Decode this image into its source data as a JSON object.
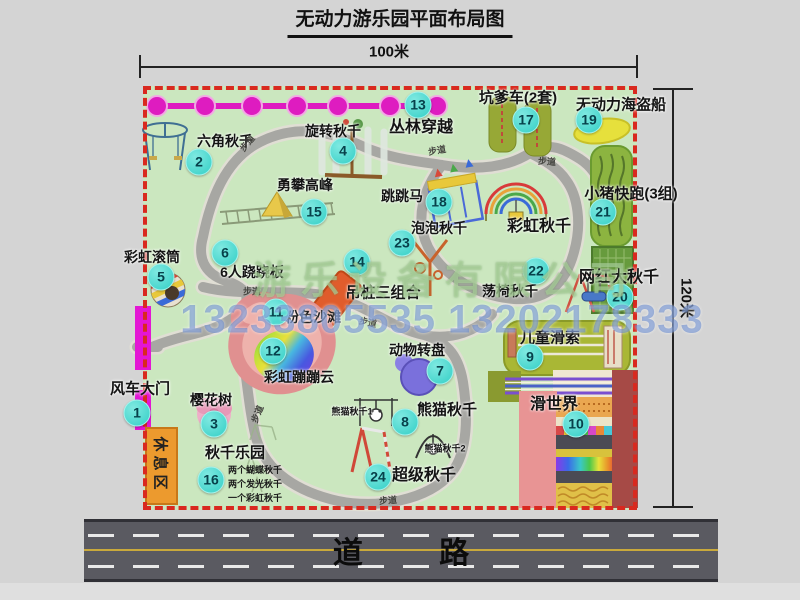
{
  "title": "无动力游乐园平面布局图",
  "dimensions": {
    "width": "100米",
    "height": "120米"
  },
  "road_label": "道 路",
  "walkway_label": "步道",
  "rest_area_label": "休息区",
  "rainbow_swing_label": "彩虹秋千",
  "watermark": {
    "company": "游乐设备有限公司",
    "phone": "13233805535 13202178333"
  },
  "colors": {
    "map_green": "#cbe7bf",
    "border_red": "#d9291f",
    "badge_teal": "#34cfc6",
    "gate_magenta": "#e316d4",
    "rest_orange": "#ec9a2e",
    "road_gray": "#5a5a61",
    "path_gray": "#a7a7a3",
    "chain_magenta": "#de1cc0"
  },
  "attractions": [
    {
      "num": "1",
      "name": "风车大门"
    },
    {
      "num": "2",
      "name": "六角秋千"
    },
    {
      "num": "3",
      "name": "樱花树"
    },
    {
      "num": "4",
      "name": "旋转秋千"
    },
    {
      "num": "5",
      "name": "彩虹滚筒"
    },
    {
      "num": "6",
      "name": "6人跷跷板"
    },
    {
      "num": "7",
      "name": "动物转盘"
    },
    {
      "num": "8",
      "name": "熊猫秋千",
      "sub_labels": [
        "熊猫秋千1",
        "熊猫秋千2"
      ]
    },
    {
      "num": "9",
      "name": "儿童滑索"
    },
    {
      "num": "10",
      "name": "滑世界"
    },
    {
      "num": "11",
      "name": "粉色沙滩"
    },
    {
      "num": "12",
      "name": "彩虹蹦蹦云"
    },
    {
      "num": "13",
      "name": "丛林穿越"
    },
    {
      "num": "14",
      "name": "吊桩三组合"
    },
    {
      "num": "15",
      "name": "勇攀高峰"
    },
    {
      "num": "16",
      "name": "秋千乐园",
      "notes": [
        "两个蝴蝶秋千",
        "两个发光秋千",
        "一个彩虹秋千"
      ]
    },
    {
      "num": "17",
      "name": "坑爹车(2套)"
    },
    {
      "num": "18",
      "name": "跳跳马"
    },
    {
      "num": "19",
      "name": "无动力海盗船"
    },
    {
      "num": "20",
      "name": "网红大秋千"
    },
    {
      "num": "21",
      "name": "小猪快跑(3组)"
    },
    {
      "num": "22",
      "name": "荡椅秋千"
    },
    {
      "num": "23",
      "name": "泡泡秋千"
    },
    {
      "num": "24",
      "name": "超级秋千"
    }
  ]
}
